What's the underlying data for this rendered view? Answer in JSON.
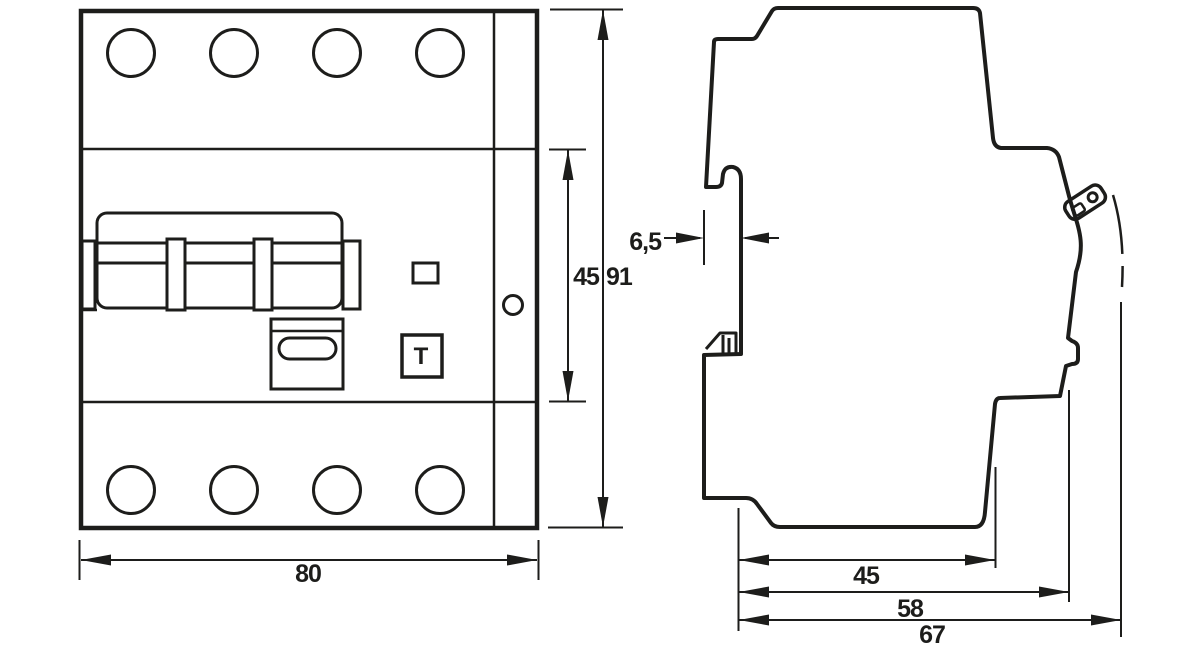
{
  "page": {
    "background": "#ffffff",
    "line_color": "#1d1d1b",
    "drawing_type": "dimension-drawing-circuit-breaker"
  },
  "views": {
    "front": {
      "test_button_label": "T",
      "dimensions": {
        "width_mm": "80",
        "total_height_mm": "91",
        "module_height_mm": "45"
      }
    },
    "side": {
      "dimensions": {
        "rail_recess_mm": "6,5",
        "depth_to_rail_mm": "45",
        "depth_body_mm": "58",
        "depth_total_mm": "67"
      }
    }
  }
}
